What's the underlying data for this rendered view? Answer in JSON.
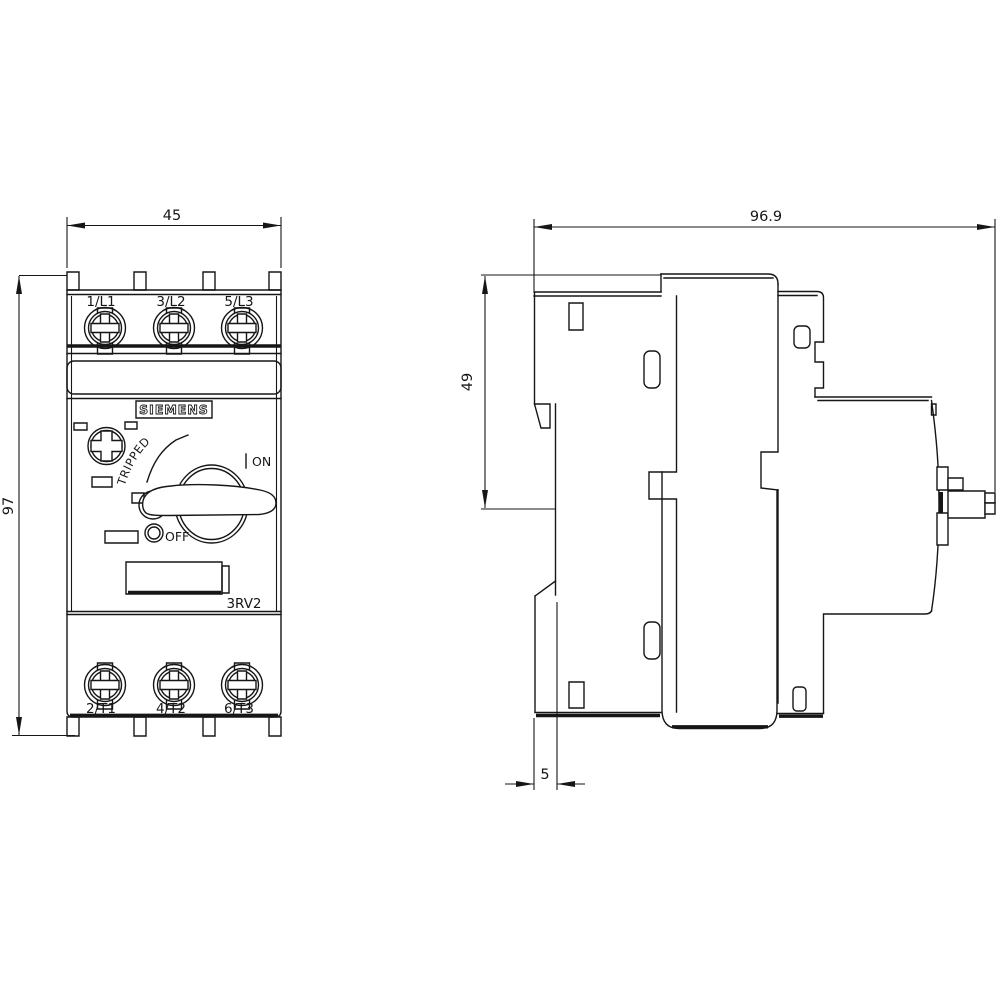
{
  "front_view": {
    "brand": "SIEMENS",
    "model": "3RV2",
    "top_terminals": [
      "1/L1",
      "3/L2",
      "5/L3"
    ],
    "bottom_terminals": [
      "2/T1",
      "4/T2",
      "6/T3"
    ],
    "states": {
      "tripped": "TRIPPED",
      "on": "ON",
      "off": "OFF"
    },
    "dim_width": "45",
    "dim_height": "97"
  },
  "side_view": {
    "dim_depth": "96.9",
    "dim_upper": "49",
    "dim_rail": "5"
  }
}
